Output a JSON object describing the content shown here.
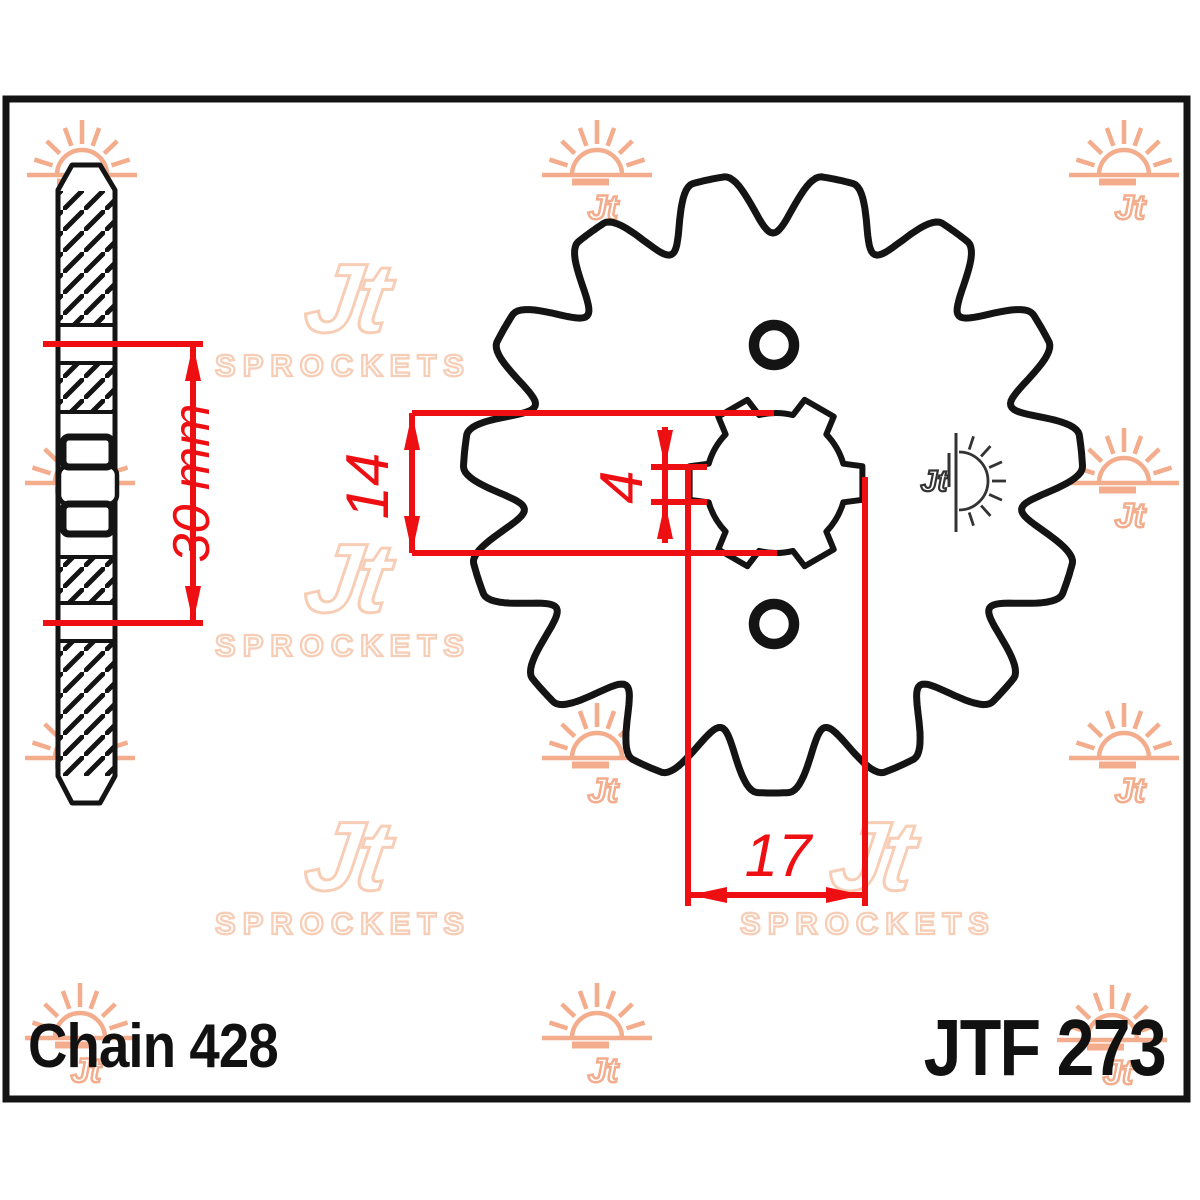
{
  "labels": {
    "chain": "Chain 428",
    "part": "JTF 273"
  },
  "dimensions": {
    "d30": {
      "label": "30 mm",
      "value_mm": 30
    },
    "d14": {
      "label": "14",
      "value_mm": 14
    },
    "d4": {
      "label": "4",
      "value_mm": 4
    },
    "d17": {
      "label": "17",
      "value_mm": 17
    }
  },
  "brand": {
    "mark": "Jt",
    "name": "SPROCKETS",
    "mini_mark": "Jt"
  },
  "colors": {
    "dimension_red": "#ee0f13",
    "line_black": "#141414",
    "watermark_sun": "#f3ac8c",
    "watermark_logo": "#f8cdb6",
    "mini_logo": "#333333",
    "background": "#ffffff"
  },
  "geometry": {
    "frame": {
      "x": 6,
      "y": 99,
      "w": 1181,
      "h": 1000,
      "stroke": 7
    },
    "front_view": {
      "center": [
        773,
        483
      ],
      "teeth": 15,
      "tip_radius": 310,
      "valley_radius": 250,
      "outline_stroke": 7,
      "bore_center": [
        776,
        483
      ],
      "bore_radius": 70,
      "spline_radius": 88,
      "spline_angles": [
        0,
        60,
        120,
        180,
        240,
        300
      ],
      "bolt_holes": [
        [
          774,
          345
        ],
        [
          774,
          624
        ]
      ],
      "bolt_hole_radius": 20,
      "bolt_hole_stroke": 10.5
    },
    "side_view": {
      "x1": 58,
      "x2": 115,
      "tip_x1": 72,
      "tip_x2": 100,
      "top_tip_y": 165,
      "top_shoulder_y": 190,
      "bottom_shoulder_y": 776,
      "bottom_tip_y": 803,
      "hatch_bands": [
        [
          191,
          325
        ],
        [
          363,
          412
        ],
        [
          557,
          603
        ],
        [
          641,
          776
        ]
      ],
      "divider_ys": [
        325,
        363,
        412,
        557,
        603,
        641
      ],
      "windows": [
        [
          63,
          437,
          49,
          30
        ],
        [
          63,
          504,
          49,
          30
        ]
      ],
      "hub_band": [
        59,
        466,
        58,
        38
      ]
    },
    "dims": {
      "d30": {
        "h1": [
          43,
          344,
          203
        ],
        "h2": [
          43,
          623,
          203
        ],
        "v": [
          193,
          344,
          623
        ],
        "label_at": [
          192,
          483
        ]
      },
      "d14": {
        "v": [
          412,
          413,
          553
        ],
        "h1": [
          412,
          413,
          774
        ],
        "h2": [
          412,
          553,
          777
        ],
        "label_at": [
          368,
          486
        ]
      },
      "d4": {
        "ticks": [
          [
            651,
            467,
            707
          ],
          [
            651,
            502,
            707
          ]
        ],
        "v": [
          665,
          427,
          543
        ],
        "label_at": [
          622,
          487
        ]
      },
      "d17": {
        "v1": [
          688,
          467,
          906
        ],
        "v2": [
          865,
          477,
          906
        ],
        "h": [
          688,
          895,
          865
        ],
        "label_at": [
          778,
          856
        ]
      }
    },
    "watermarks": {
      "suns": [
        [
          82,
          175
        ],
        [
          597,
          175
        ],
        [
          1124,
          175
        ],
        [
          80,
          483
        ],
        [
          597,
          483
        ],
        [
          1124,
          483
        ],
        [
          80,
          758
        ],
        [
          597,
          758
        ],
        [
          1124,
          758
        ],
        [
          80,
          1038
        ],
        [
          597,
          1038
        ],
        [
          1112,
          1040
        ]
      ],
      "logos": [
        [
          343,
          320
        ],
        [
          868,
          320
        ],
        [
          343,
          600
        ],
        [
          868,
          600
        ],
        [
          343,
          878
        ],
        [
          868,
          878
        ]
      ]
    },
    "mini_logo_at": [
      956,
      481
    ]
  }
}
